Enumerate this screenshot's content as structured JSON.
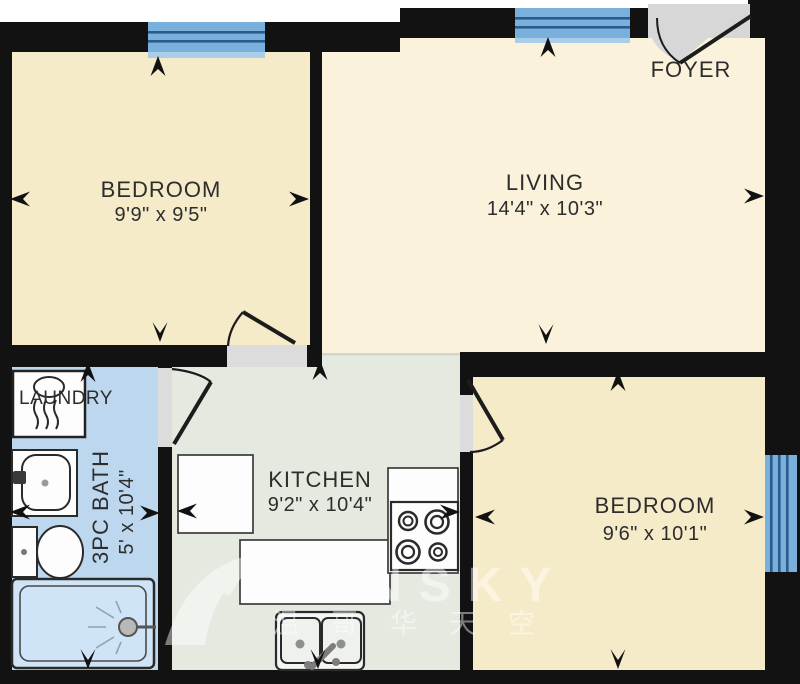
{
  "plan_title": "Apartment floor plan",
  "rooms": {
    "bedroom1": {
      "name": "BEDROOM",
      "dims": "9'9\" x 9'5\""
    },
    "living": {
      "name": "LIVING",
      "dims": "14'4\" x 10'3\""
    },
    "foyer": {
      "name": "FOYER"
    },
    "laundry": {
      "name": "LAUNDRY"
    },
    "bath": {
      "name": "3PC BATH",
      "dims": "5' x 10'4\""
    },
    "kitchen": {
      "name": "KITCHEN",
      "dims": "9'2\" x 10'4\""
    },
    "bedroom2": {
      "name": "BEDROOM",
      "dims": "9'6\" x 10'1\""
    }
  },
  "watermark": {
    "brand": "VANSKY",
    "cjk": "温哥华天空"
  },
  "colors": {
    "wall": "#121212",
    "bedroom": "#f6ebc9",
    "living": "#faf2da",
    "kitchen": "#e5eae1",
    "bath": "#bdd8ee",
    "shower": "#cfe4f6",
    "window": "#79b0dc",
    "window_line": "#2b5a8c",
    "sill": "#aacdea",
    "entry": "#d7d7d7",
    "threshold": "#dcdcdc",
    "fixture": "#fdfdfd",
    "label": "#2d2d2d",
    "arrow": "#111111",
    "watermark": "#ffffff"
  }
}
